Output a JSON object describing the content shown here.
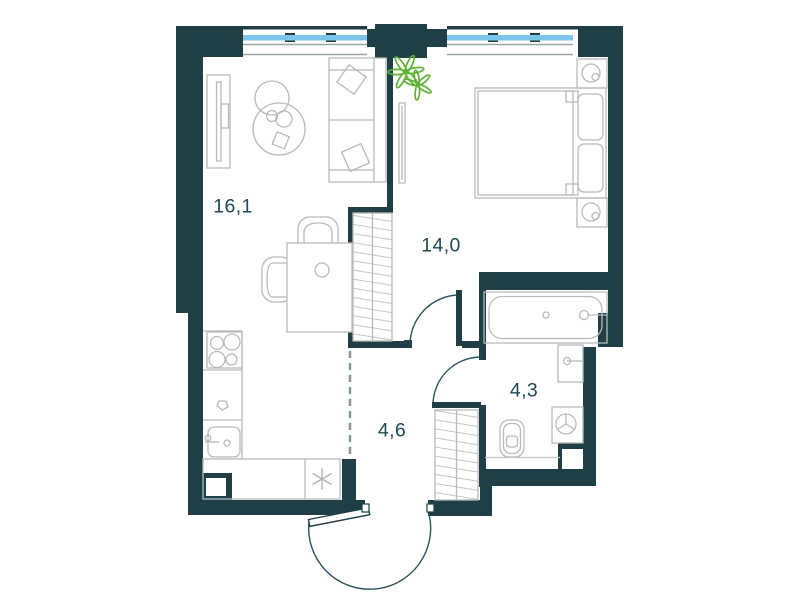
{
  "rooms": [
    {
      "id": "living-kitchen",
      "area": "16,1"
    },
    {
      "id": "bedroom",
      "area": "14,0"
    },
    {
      "id": "bathroom",
      "area": "4,3"
    },
    {
      "id": "hallway",
      "area": "4,6"
    }
  ],
  "fixtures": [
    "sofa",
    "tv-console",
    "coffee-table",
    "pouf",
    "dining-table",
    "dining-chair",
    "stove",
    "kitchen-sink",
    "kitchen-counter",
    "appliance-asterisk",
    "bed",
    "nightstand-lamp",
    "wardrobe",
    "mirror",
    "plant",
    "bathtub",
    "washbasin",
    "washing-machine",
    "toilet",
    "hall-closet",
    "entry-door",
    "bedroom-door",
    "bathroom-door"
  ],
  "palette": {
    "wall": "#1F3E46",
    "furniture_line": "#B6BBBA",
    "door_line": "#2B535C",
    "window_glass": "#7CC5EA",
    "plant": "#5FB234",
    "label_text": "#1C4954",
    "dashed_divider": "#7E9897"
  }
}
